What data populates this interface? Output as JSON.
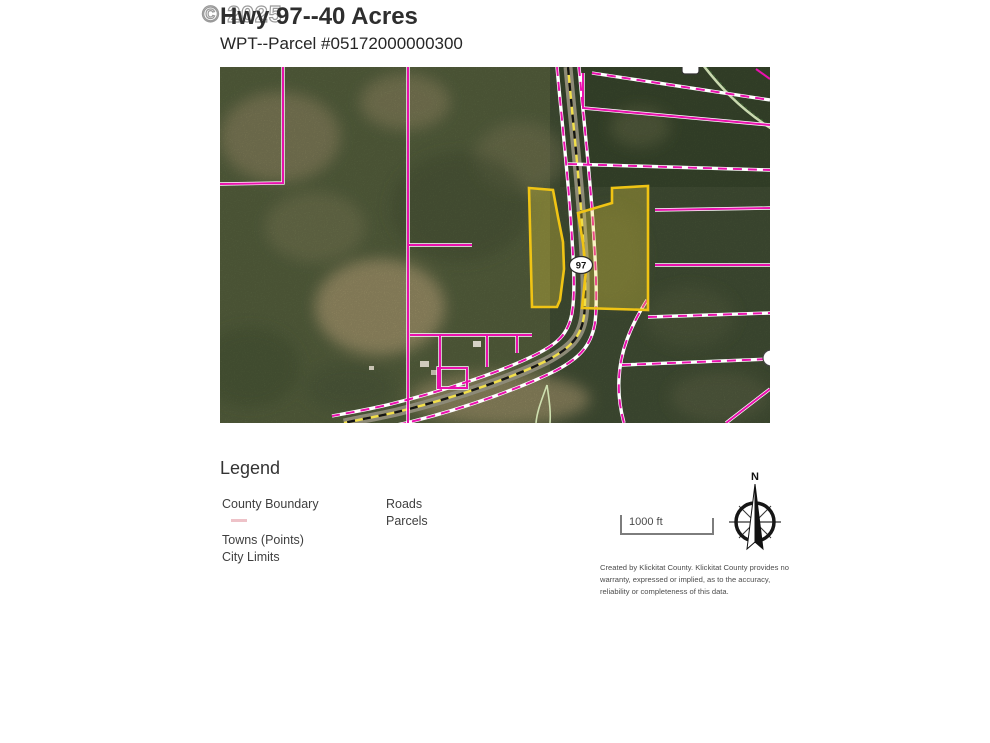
{
  "watermark_text": "© 2025",
  "header": {
    "title": "Hwy 97--40 Acres",
    "subtitle": "WPT--Parcel #05172000000300"
  },
  "map": {
    "shield_label": "97"
  },
  "legend": {
    "heading": "Legend",
    "items_left": [
      {
        "label": "County Boundary"
      },
      {
        "label": "Towns (Points)"
      },
      {
        "label": "City Limits"
      }
    ],
    "items_right": [
      {
        "label": "Roads"
      },
      {
        "label": "Parcels"
      }
    ],
    "county_boundary_swatch_color": "#eec2c8",
    "scale_label": "1000 ft",
    "north_label": "N",
    "attribution_lines": [
      "Created by Klickitat County. Klickitat County provides no",
      "warranty, expressed or implied, as to the accuracy,",
      "reliability or completeness of this data."
    ]
  },
  "colors": {
    "parcel_line": "#e911ad",
    "subject_parcel_outline": "#f0c414",
    "highway_centerline_yellow": "#f3e049"
  }
}
